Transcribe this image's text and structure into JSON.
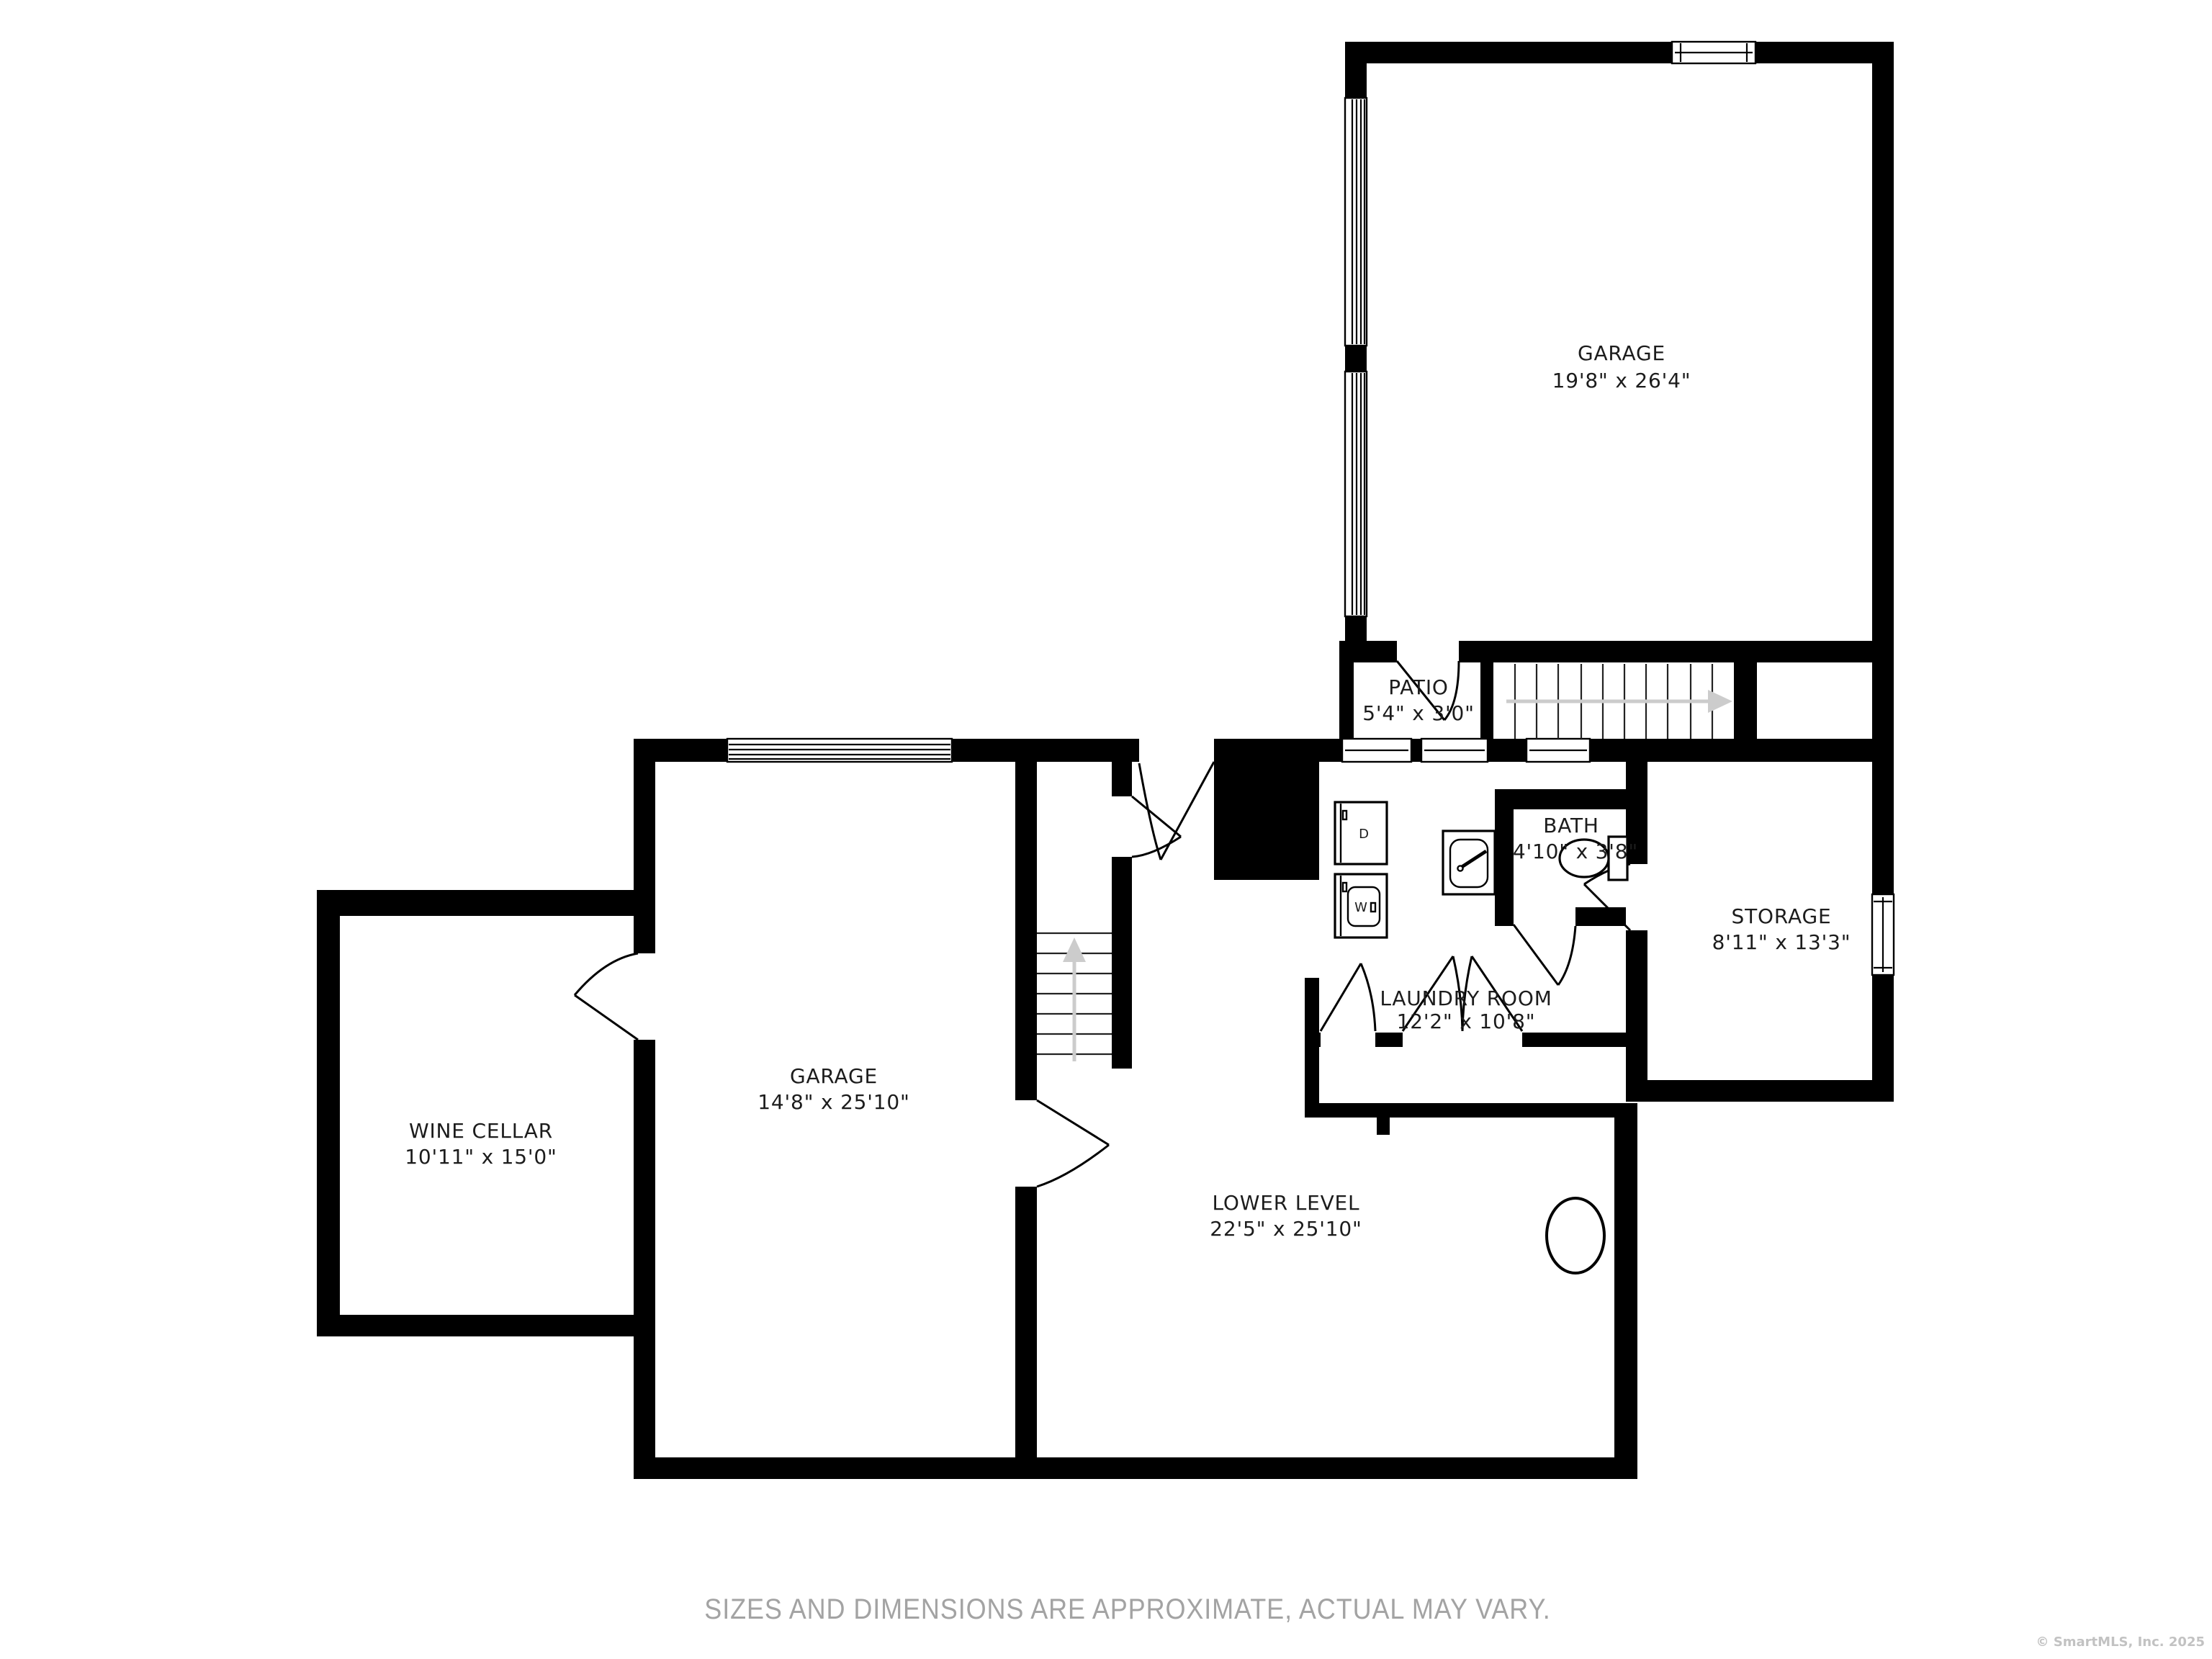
{
  "plan": {
    "rooms": [
      {
        "id": "garage-upper",
        "name": "GARAGE",
        "dims": "19'8\" x 26'4\""
      },
      {
        "id": "patio",
        "name": "PATIO",
        "dims": "5'4\" x 3'0\""
      },
      {
        "id": "bath",
        "name": "BATH",
        "dims": "4'10\" x 3'8\""
      },
      {
        "id": "laundry",
        "name": "LAUNDRY ROOM",
        "dims": "12'2\" x 10'8\""
      },
      {
        "id": "storage",
        "name": "STORAGE",
        "dims": "8'11\" x 13'3\""
      },
      {
        "id": "wine-cellar",
        "name": "WINE CELLAR",
        "dims": "10'11\" x 15'0\""
      },
      {
        "id": "garage-lower",
        "name": "GARAGE",
        "dims": "14'8\" x 25'10\""
      },
      {
        "id": "lower-level",
        "name": "LOWER LEVEL",
        "dims": "22'5\" x 25'10\""
      }
    ],
    "appliances": {
      "washer": "W",
      "dryer": "D"
    },
    "footer": {
      "disclaimer": "SIZES AND DIMENSIONS ARE APPROXIMATE, ACTUAL MAY VARY.",
      "copyright": "© SmartMLS, Inc. 2025"
    },
    "colors": {
      "wall": "#000000",
      "label": "#1c1c1c",
      "muted": "#a3a3a3",
      "faint": "#c2c2c2",
      "arrow": "#cccccc"
    }
  }
}
